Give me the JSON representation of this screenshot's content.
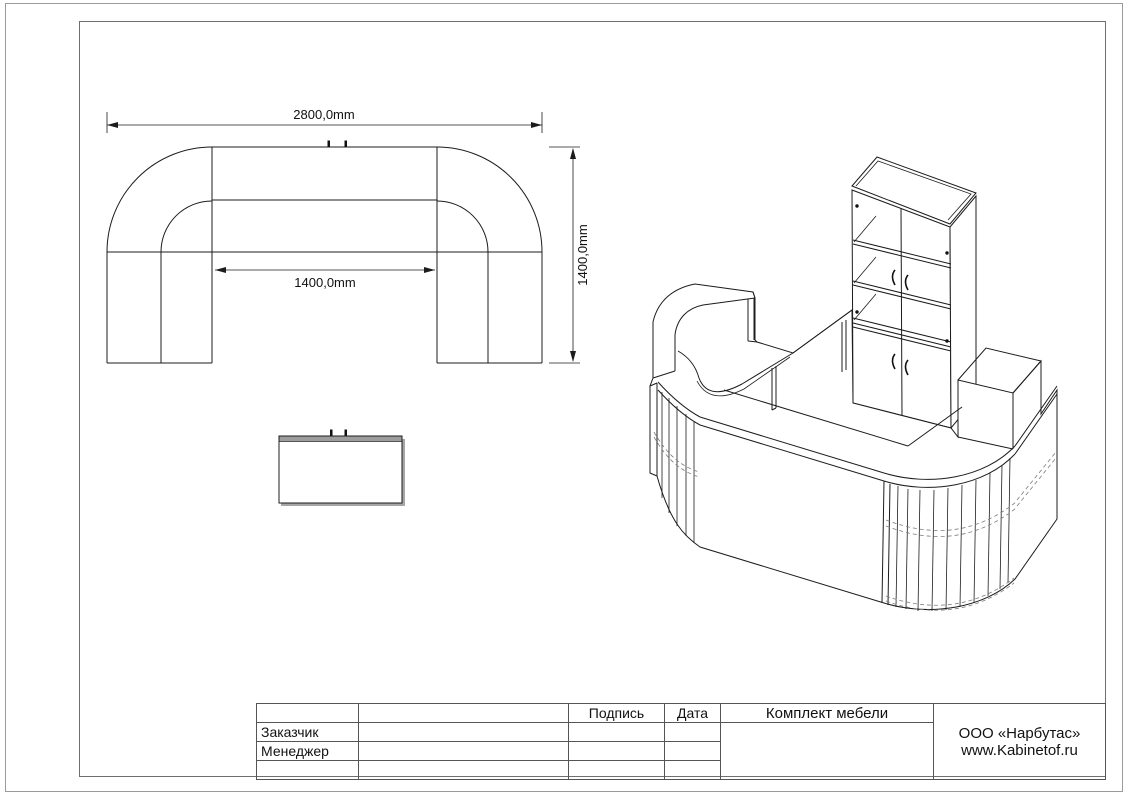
{
  "page": {
    "background": "#ffffff",
    "border_color": "#9a9a9a",
    "frame_color": "#6f6f6f",
    "line_color": "#1c1c1c"
  },
  "plan_view": {
    "dim_total_width": "2800,0mm",
    "dim_inner_width": "1400,0mm",
    "dim_depth": "1400,0mm"
  },
  "title_block": {
    "header": {
      "signature": "Подпись",
      "date": "Дата"
    },
    "rows": [
      {
        "label": "Заказчик"
      },
      {
        "label": "Менеджер"
      }
    ],
    "project_title": "Комплект мебели",
    "company": {
      "name": "ООО «Нарбутас»",
      "website": "www.Kabinetof.ru"
    }
  }
}
